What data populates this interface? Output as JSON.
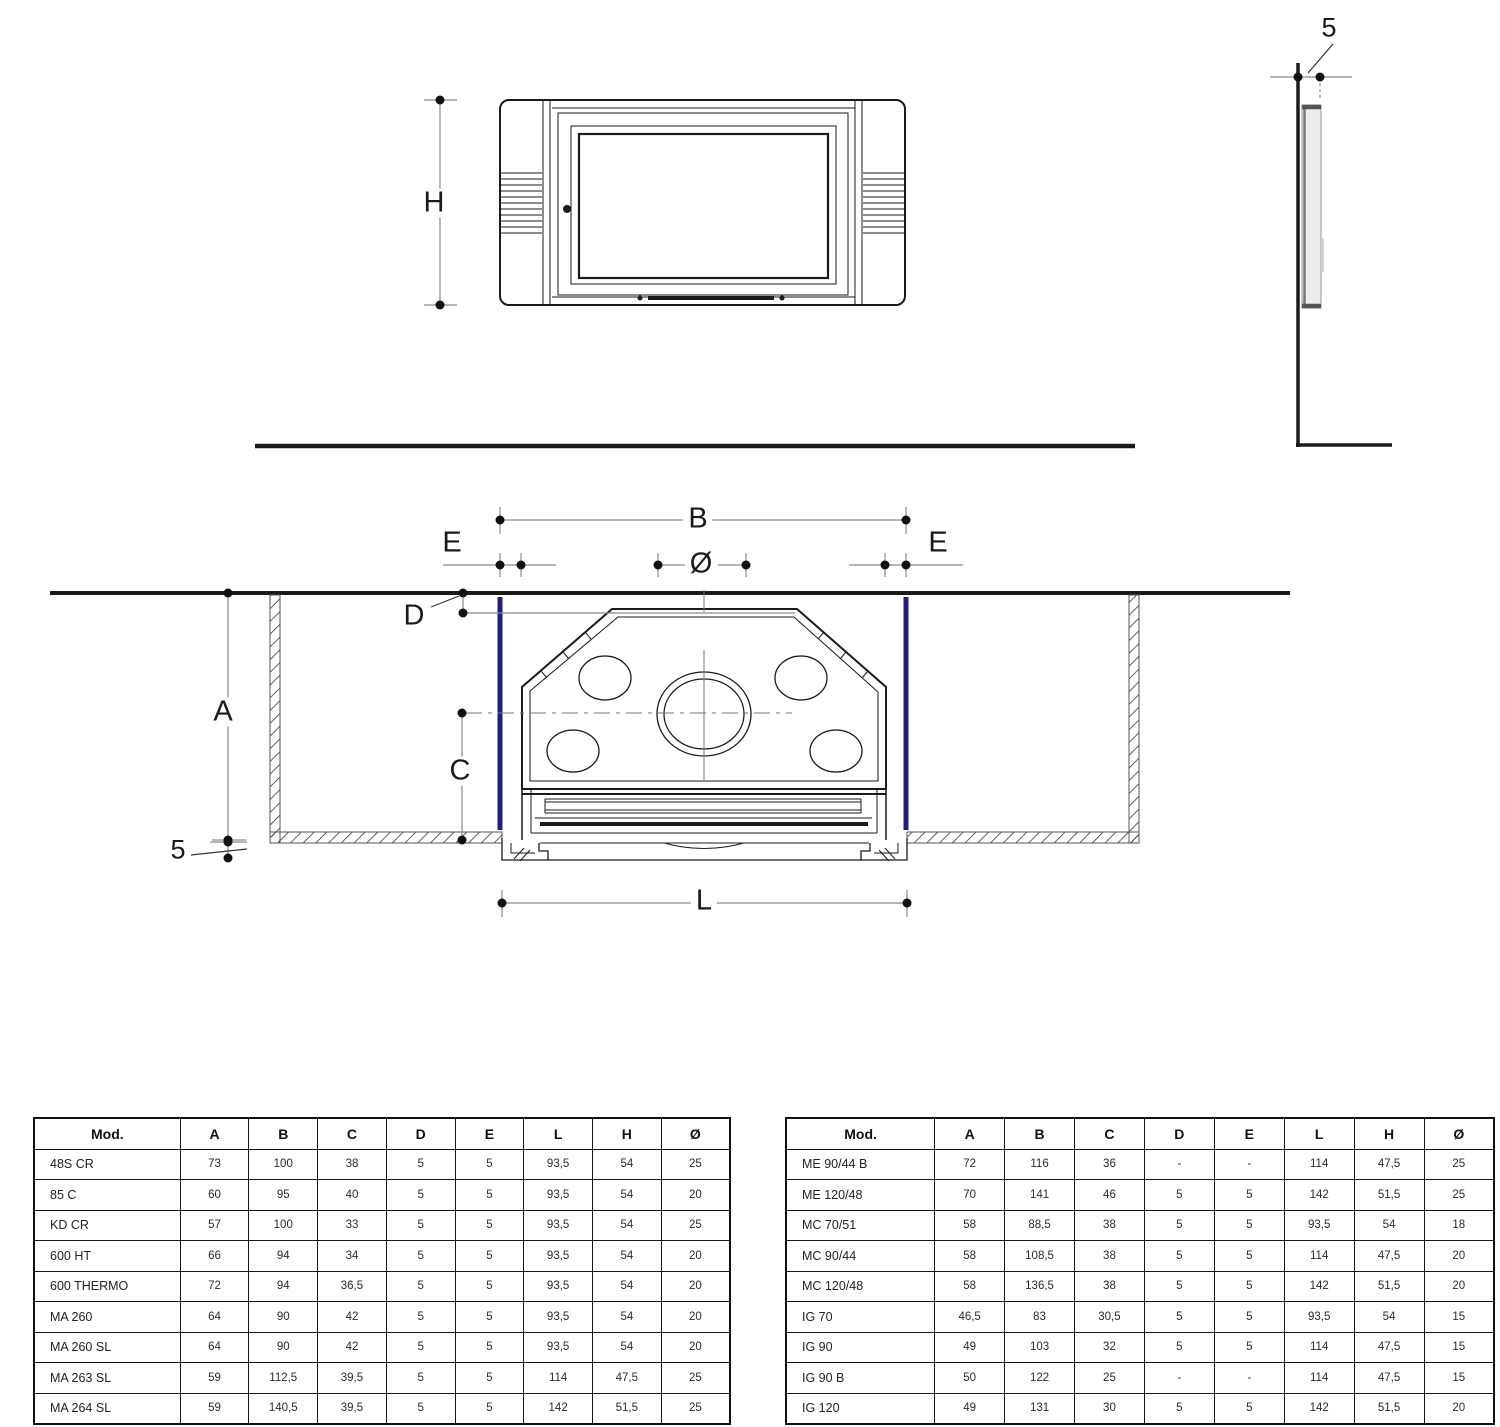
{
  "colors": {
    "accent_blue": "#20207c",
    "line_dark": "#1a1a1a",
    "dim_gray": "#8a8a8a"
  },
  "drawing": {
    "front_view": {
      "h_label": "H"
    },
    "side_view": {
      "gap_label": "5"
    },
    "plan_view": {
      "b_label": "B",
      "e_left_label": "E",
      "e_right_label": "E",
      "dia_label": "Ø",
      "d_label": "D",
      "a_label": "A",
      "c_label": "C",
      "l_label": "L",
      "gap_label": "5"
    }
  },
  "tables": {
    "headers": [
      "Mod.",
      "A",
      "B",
      "C",
      "D",
      "E",
      "L",
      "H",
      "Ø"
    ],
    "left_table": {
      "rows": [
        [
          "48S CR",
          "73",
          "100",
          "38",
          "5",
          "5",
          "93,5",
          "54",
          "25"
        ],
        [
          "85 C",
          "60",
          "95",
          "40",
          "5",
          "5",
          "93,5",
          "54",
          "20"
        ],
        [
          "KD CR",
          "57",
          "100",
          "33",
          "5",
          "5",
          "93,5",
          "54",
          "25"
        ],
        [
          "600 HT",
          "66",
          "94",
          "34",
          "5",
          "5",
          "93,5",
          "54",
          "20"
        ],
        [
          "600 THERMO",
          "72",
          "94",
          "36,5",
          "5",
          "5",
          "93,5",
          "54",
          "20"
        ],
        [
          "MA 260",
          "64",
          "90",
          "42",
          "5",
          "5",
          "93,5",
          "54",
          "20"
        ],
        [
          "MA 260 SL",
          "64",
          "90",
          "42",
          "5",
          "5",
          "93,5",
          "54",
          "20"
        ],
        [
          "MA 263 SL",
          "59",
          "112,5",
          "39,5",
          "5",
          "5",
          "114",
          "47,5",
          "25"
        ],
        [
          "MA 264 SL",
          "59",
          "140,5",
          "39,5",
          "5",
          "5",
          "142",
          "51,5",
          "25"
        ]
      ]
    },
    "right_table": {
      "rows": [
        [
          "ME 90/44 B",
          "72",
          "116",
          "36",
          "-",
          "-",
          "114",
          "47,5",
          "25"
        ],
        [
          "ME 120/48",
          "70",
          "141",
          "46",
          "5",
          "5",
          "142",
          "51,5",
          "25"
        ],
        [
          "MC 70/51",
          "58",
          "88,5",
          "38",
          "5",
          "5",
          "93,5",
          "54",
          "18"
        ],
        [
          "MC 90/44",
          "58",
          "108,5",
          "38",
          "5",
          "5",
          "114",
          "47,5",
          "20"
        ],
        [
          "MC 120/48",
          "58",
          "136,5",
          "38",
          "5",
          "5",
          "142",
          "51,5",
          "20"
        ],
        [
          "IG 70",
          "46,5",
          "83",
          "30,5",
          "5",
          "5",
          "93,5",
          "54",
          "15"
        ],
        [
          "IG 90",
          "49",
          "103",
          "32",
          "5",
          "5",
          "114",
          "47,5",
          "15"
        ],
        [
          "IG 90 B",
          "50",
          "122",
          "25",
          "-",
          "-",
          "114",
          "47,5",
          "15"
        ],
        [
          "IG 120",
          "49",
          "131",
          "30",
          "5",
          "5",
          "142",
          "51,5",
          "20"
        ]
      ]
    }
  }
}
